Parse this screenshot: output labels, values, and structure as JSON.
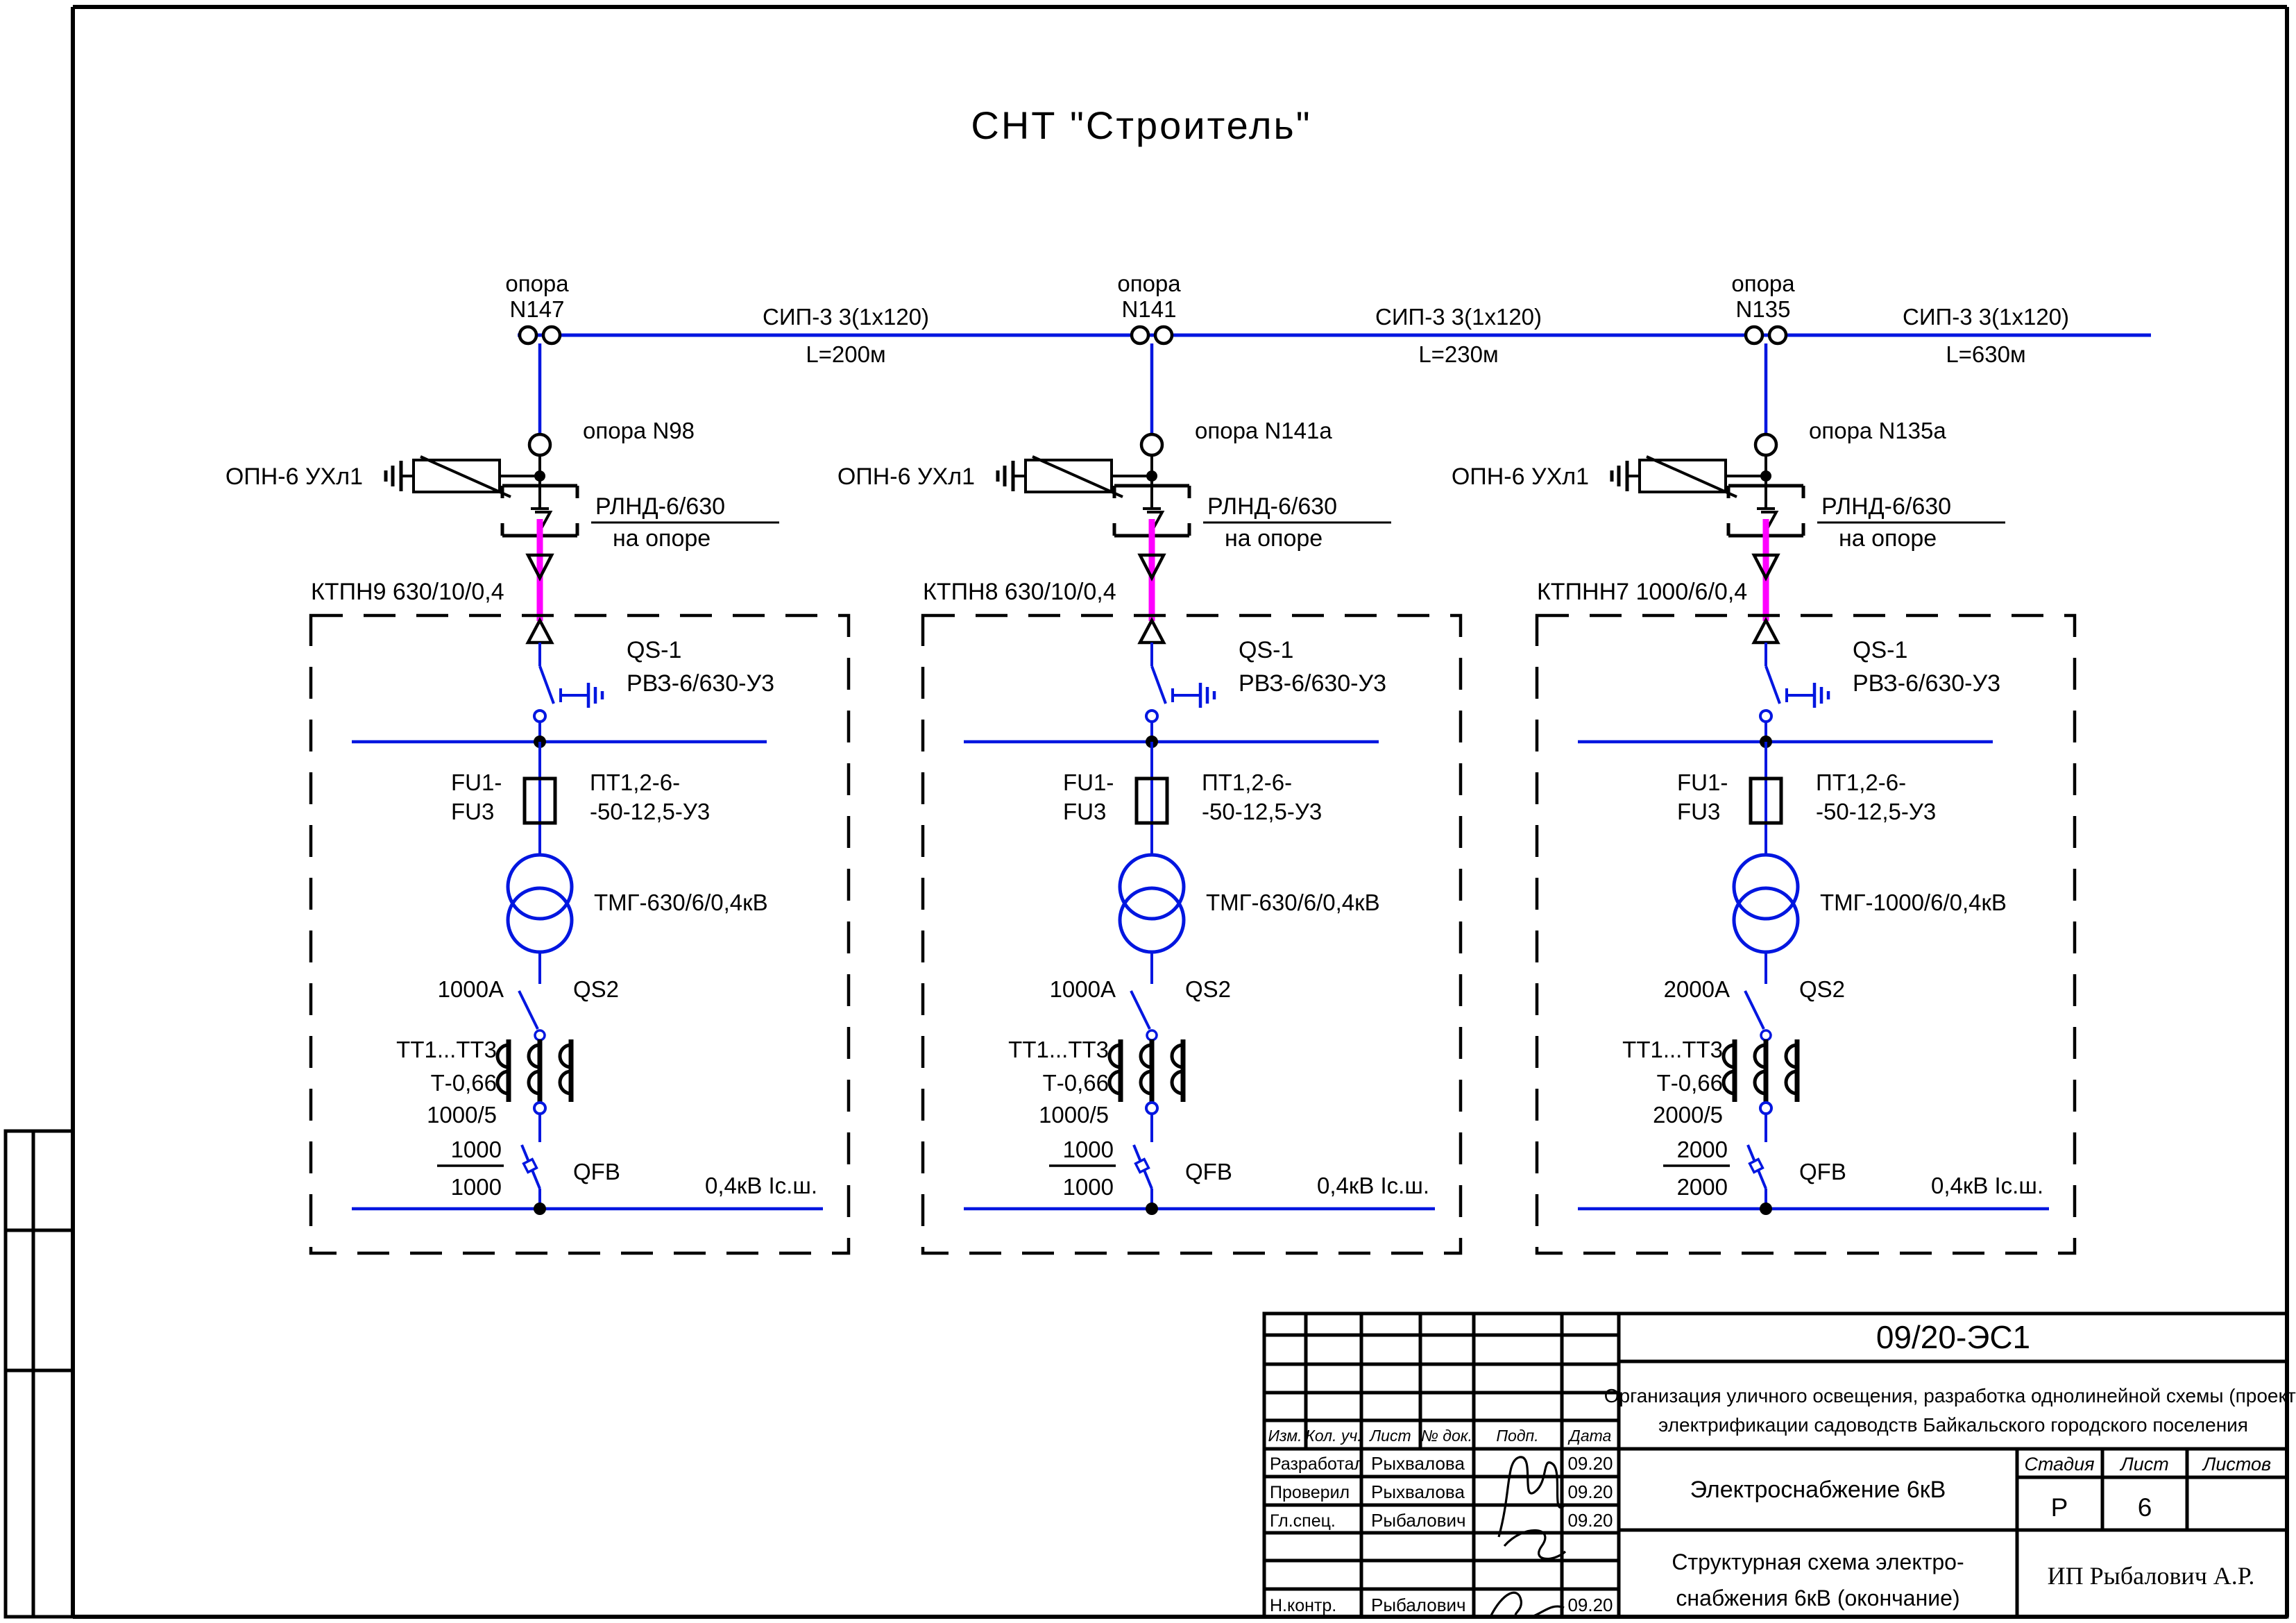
{
  "sheet": {
    "title": "СНТ \"Строитель\""
  },
  "colors": {
    "blue": "#0016e0",
    "magenta": "#ff00ff",
    "black": "#000000"
  },
  "segments": [
    {
      "cable": "СИП-3  3(1х120)",
      "length": "L=200м"
    },
    {
      "cable": "СИП-3  3(1х120)",
      "length": "L=230м"
    },
    {
      "cable": "СИП-3  3(1х120)",
      "length": "L=630м"
    }
  ],
  "units": [
    {
      "pole_word": "опора",
      "pole_no": "N147",
      "arrester_label": "ОПН-6 УХл1",
      "tap_pole_label": "опора N98",
      "disconnector_label": "РЛНД-6/630",
      "disconnector_sub": "на опоре",
      "station_label": "КТПН9  630/10/0,4",
      "qs1_label": "QS-1",
      "qs1_type": "РВЗ-6/630-У3",
      "fuse_label_1": "FU1-",
      "fuse_label_2": "FU3",
      "fuse_type_1": "ПТ1,2-6-",
      "fuse_type_2": "-50-12,5-У3",
      "transformer_label": "ТМГ-630/6/0,4кВ",
      "qs2_current": "1000А",
      "qs2_label": "QS2",
      "ct_label_1": "ТТ1...ТТ3",
      "ct_label_2": "Т-0,66",
      "ct_label_3": "1000/5",
      "qfb_num": "1000",
      "qfb_den": "1000",
      "qfb_label": "QFB",
      "lv_bus_label": "0,4кВ  Iс.ш."
    },
    {
      "pole_word": "опора",
      "pole_no": "N141",
      "arrester_label": "ОПН-6 УХл1",
      "tap_pole_label": "опора N141а",
      "disconnector_label": "РЛНД-6/630",
      "disconnector_sub": "на опоре",
      "station_label": "КТПН8  630/10/0,4",
      "qs1_label": "QS-1",
      "qs1_type": "РВЗ-6/630-У3",
      "fuse_label_1": "FU1-",
      "fuse_label_2": "FU3",
      "fuse_type_1": "ПТ1,2-6-",
      "fuse_type_2": "-50-12,5-У3",
      "transformer_label": "ТМГ-630/6/0,4кВ",
      "qs2_current": "1000А",
      "qs2_label": "QS2",
      "ct_label_1": "ТТ1...ТТ3",
      "ct_label_2": "Т-0,66",
      "ct_label_3": "1000/5",
      "qfb_num": "1000",
      "qfb_den": "1000",
      "qfb_label": "QFB",
      "lv_bus_label": "0,4кВ  Iс.ш."
    },
    {
      "pole_word": "опора",
      "pole_no": "N135",
      "arrester_label": "ОПН-6 УХл1",
      "tap_pole_label": "опора N135а",
      "disconnector_label": "РЛНД-6/630",
      "disconnector_sub": "на опоре",
      "station_label": "КТПНН7 1000/6/0,4",
      "qs1_label": "QS-1",
      "qs1_type": "РВЗ-6/630-У3",
      "fuse_label_1": "FU1-",
      "fuse_label_2": "FU3",
      "fuse_type_1": "ПТ1,2-6-",
      "fuse_type_2": "-50-12,5-У3",
      "transformer_label": "ТМГ-1000/6/0,4кВ",
      "qs2_current": "2000А",
      "qs2_label": "QS2",
      "ct_label_1": "ТТ1...ТТ3",
      "ct_label_2": "Т-0,66",
      "ct_label_3": "2000/5",
      "qfb_num": "2000",
      "qfb_den": "2000",
      "qfb_label": "QFB",
      "lv_bus_label": "0,4кВ  Iс.ш."
    }
  ],
  "title_block": {
    "doc_number": "09/20-ЭС1",
    "project_line1": "Организация уличного освещения, разработка однолинейной схемы (проект)",
    "project_line2": "электрификации садоводств Байкальского городского поселения",
    "section_title": "Электроснабжение 6кВ",
    "sheet_title_line1": "Структурная схема электро-",
    "sheet_title_line2": "снабжения 6кВ (окончание)",
    "company": "ИП Рыбалович А.Р.",
    "col_izm": "Изм.",
    "col_kol": "Кол. уч.",
    "col_list": "Лист",
    "col_doc": "№ док.",
    "col_podp": "Подп.",
    "col_data": "Дата",
    "stage_header": "Стадия",
    "sheet_header": "Лист",
    "sheets_header": "Листов",
    "stage_value": "Р",
    "sheet_value": "6",
    "sheets_value": "",
    "rows": [
      {
        "role": "Разработал",
        "name": "Рыхвалова",
        "date": "09.20"
      },
      {
        "role": "Проверил",
        "name": "Рыхвалова",
        "date": "09.20"
      },
      {
        "role": "Гл.спец.",
        "name": "Рыбалович",
        "date": "09.20"
      },
      {
        "role": "",
        "name": "",
        "date": ""
      },
      {
        "role": "",
        "name": "",
        "date": ""
      },
      {
        "role": "Н.контр.",
        "name": "Рыбалович",
        "date": "09.20"
      }
    ]
  }
}
